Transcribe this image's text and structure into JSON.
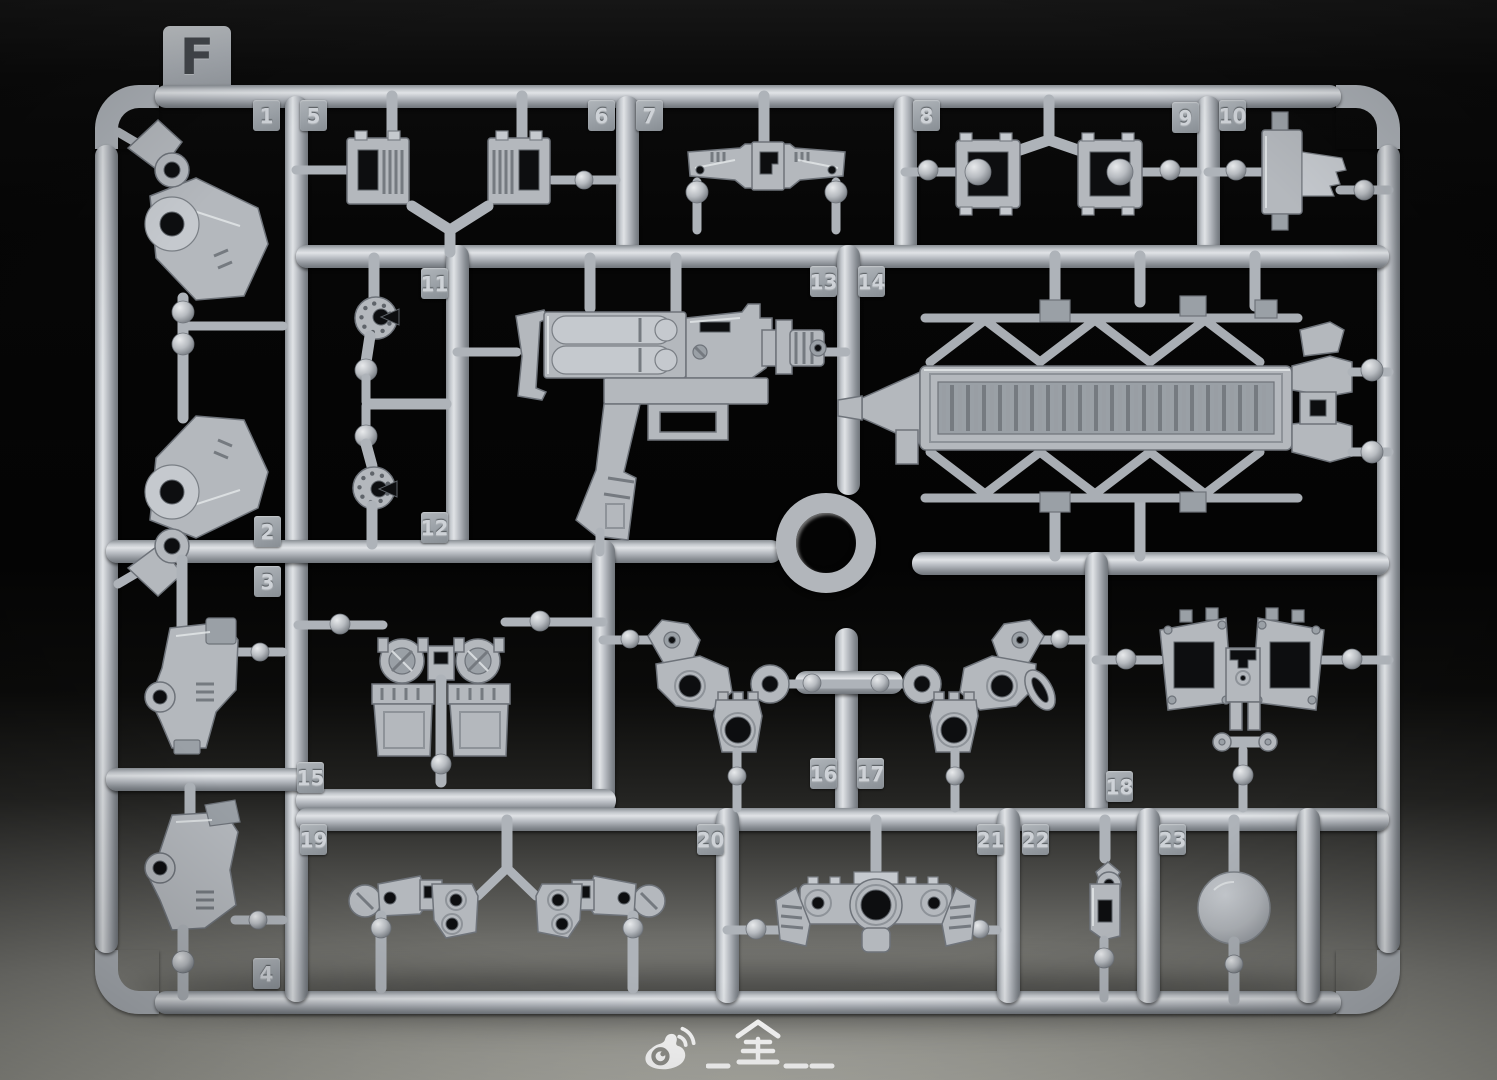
{
  "sprue": {
    "letter": "F",
    "tags": [
      {
        "label": "1"
      },
      {
        "label": "2"
      },
      {
        "label": "3"
      },
      {
        "label": "4"
      },
      {
        "label": "5"
      },
      {
        "label": "6"
      },
      {
        "label": "7"
      },
      {
        "label": "8"
      },
      {
        "label": "9"
      },
      {
        "label": "10"
      },
      {
        "label": "11"
      },
      {
        "label": "12"
      },
      {
        "label": "13"
      },
      {
        "label": "14"
      },
      {
        "label": "15"
      },
      {
        "label": "16"
      },
      {
        "label": "17"
      },
      {
        "label": "18"
      },
      {
        "label": "19"
      },
      {
        "label": "20"
      },
      {
        "label": "21"
      },
      {
        "label": "22"
      },
      {
        "label": "23"
      }
    ]
  },
  "watermark": {
    "icon": "weibo-logo-icon",
    "text": "_全__"
  },
  "colors": {
    "plastic": "#b4b8bd",
    "plastic_highlight": "#e2e5e8",
    "plastic_shadow": "#71767c",
    "tag_plastic": "#9aa0a6",
    "background_top": "#060606",
    "floor": "#9a9a95",
    "watermark": "#ffffff"
  }
}
